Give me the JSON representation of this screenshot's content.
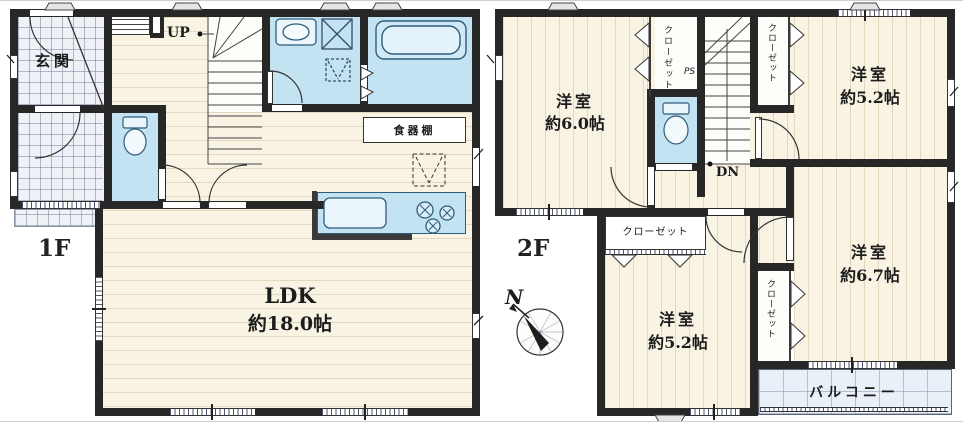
{
  "floor1": {
    "label": "1F",
    "entrance_label": "玄関",
    "up_label": "UP",
    "cupboard_label": "食器棚",
    "ldk_name": "LDK",
    "ldk_size": "約18.0帖"
  },
  "floor2": {
    "label": "2F",
    "dn_label": "DN",
    "ps_label": "PS",
    "north_label": "N",
    "balcony_label": "バルコニー",
    "rooms": {
      "nw": {
        "name": "洋室",
        "size": "約6.0帖"
      },
      "ne": {
        "name": "洋室",
        "size": "約5.2帖"
      },
      "se": {
        "name": "洋室",
        "size": "約6.7帖"
      },
      "s": {
        "name": "洋室",
        "size": "約5.2帖"
      }
    },
    "closets": {
      "mid": "クローゼット",
      "ne": "クローゼット",
      "s": "クローゼット",
      "se": "クローゼット"
    }
  },
  "colors": {
    "wall": "#272727",
    "floor_cream": "#f8f3e3",
    "wet_blue": "#c3e2f2",
    "entrance_tile": "#eef2f6",
    "balcony": "#eaf0f7",
    "fixture_stroke": "#2f5d7a"
  }
}
